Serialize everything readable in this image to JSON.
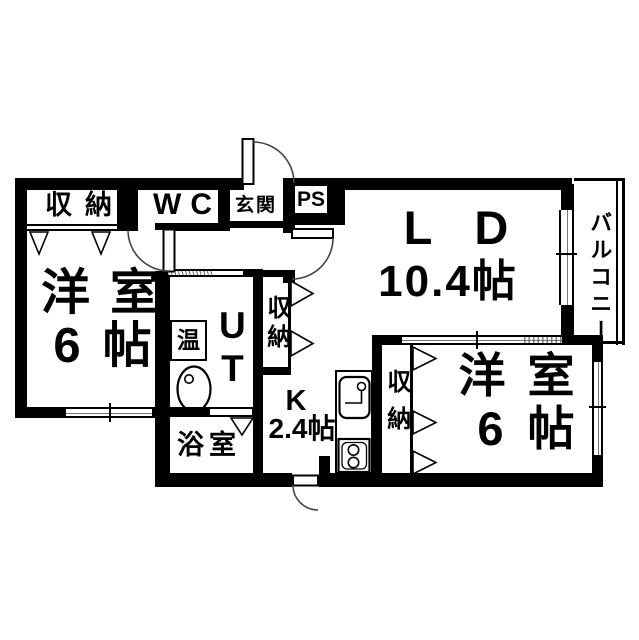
{
  "plan": {
    "closet_nw": {
      "label": "収納"
    },
    "wc": {
      "label": "WC"
    },
    "entrance": {
      "label": "玄関"
    },
    "pipe_space": {
      "label": "PS"
    },
    "living_dining": {
      "label": "LD",
      "size": "10.4帖"
    },
    "balcony": {
      "label": "バルコニー"
    },
    "bedroom_left": {
      "label": "洋室",
      "size": "6帖"
    },
    "utility": {
      "label": "UT"
    },
    "water_heater": {
      "label": "温"
    },
    "closet_hall": {
      "label": "収納"
    },
    "bathroom": {
      "label": "浴室"
    },
    "kitchen": {
      "label": "K",
      "size": "2.4帖"
    },
    "closet_right": {
      "label": "収納"
    },
    "bedroom_right": {
      "label": "洋室",
      "size": "6帖"
    }
  },
  "colors": {
    "wall": "#000000",
    "background": "#ffffff",
    "door_arc": "#444444"
  }
}
